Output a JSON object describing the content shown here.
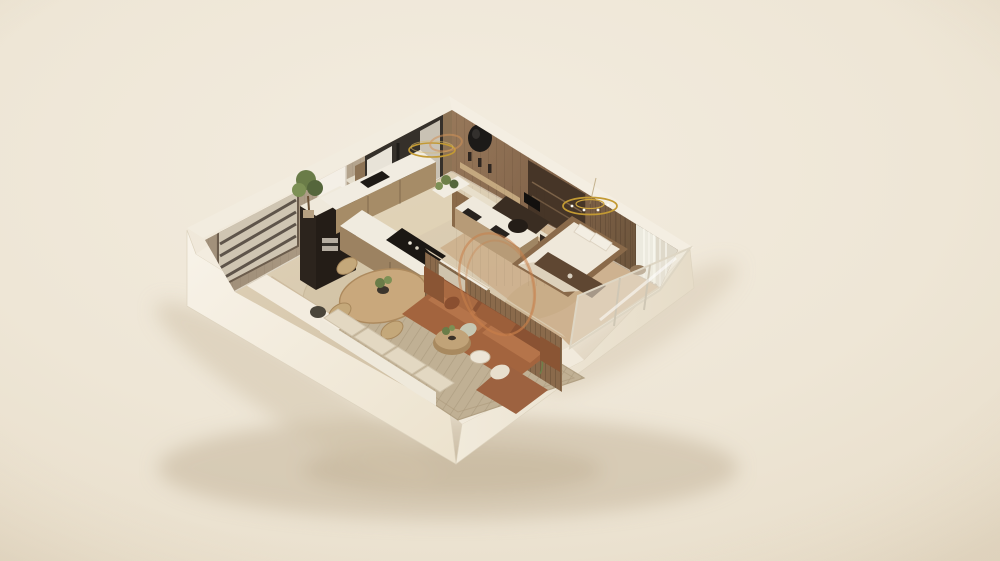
{
  "scene": {
    "description": "Photorealistic isometric 3D cutaway (dollhouse) render of a one-bedroom apartment model on a plain cream studio backdrop",
    "view": "isometric birds-eye cutaway, walls sliced low on the two front sides",
    "rooms": [
      "entry-hall",
      "kitchen",
      "dining-area",
      "living-room",
      "bathroom-corridor",
      "study-nook",
      "bedroom"
    ],
    "objects": [
      "slatted-entry-door",
      "potted-tree",
      "framed-wall-panel",
      "window-with-curtains",
      "tall-dark-cabinet-tower",
      "l-shaped-kitchen-counter",
      "black-cooktop",
      "round-dining-table",
      "dining-chairs",
      "round-jute-rug",
      "leather-sofa",
      "chaise-extension",
      "coffee-table-set",
      "robot-vacuum",
      "woven-area-rug",
      "window-bench-cushions",
      "slatted-partition-with-planter",
      "wall-mirror",
      "vanity-with-dark-basins",
      "planter-box",
      "desk-with-monitor",
      "desk-chair",
      "round-wall-art",
      "floating-shelf",
      "platform-bed",
      "pillows",
      "foot-bench",
      "side-table",
      "gold-ring-pendant-light",
      "gold-ring-chandelier",
      "shimmer-curtain",
      "glass-curtain-wall",
      "orange-sketch-annotations"
    ],
    "annotations": {
      "count": 2,
      "style": "hand-drawn orange ellipse highlights",
      "locations": [
        "around living-room sofa and partition",
        "around ring pendant light near kitchen window"
      ]
    }
  },
  "palette": {
    "background_top": "#f2ebdf",
    "background_bottom": "#e9dfcd",
    "shadow": "#c9bba1",
    "shell_bright": "#f7f2e8",
    "shell": "#efe8d8",
    "wall_top_band": "#f2ecdf",
    "greige_wall": "#b7a78f",
    "wood_wall": "#8a6b4c",
    "wood_wall_dark": "#6f5539",
    "partition_wood": "#8a6a4b",
    "floor": "#d8c9af",
    "bedroom_floor": "#cdb18e",
    "rug": "#c0b094",
    "dining_rug": "#d3c4a7",
    "counter_white": "#f1ece1",
    "cabinet_wood": "#a68c67",
    "cabinet_dark": "#2c241d",
    "cooktop": "#1b1713",
    "sofa": "#a3643e",
    "sofa_dark": "#8a5233",
    "cushion": "#b5744a",
    "pillow_light": "#e8dfcd",
    "pillow_sage": "#c6c7b2",
    "bed_mattress": "#efe8da",
    "bed_platform": "#8a6a4a",
    "bench_wood": "#5f4732",
    "greenery": "#6a7c48",
    "greenery_dark": "#55663c",
    "blossom": "#c77d85",
    "gold": "#c39a33",
    "annotation": "#c87f4b",
    "glass": "#e6e0d2",
    "curtain": "#efeae0",
    "frame_dark": "#3a3430"
  }
}
